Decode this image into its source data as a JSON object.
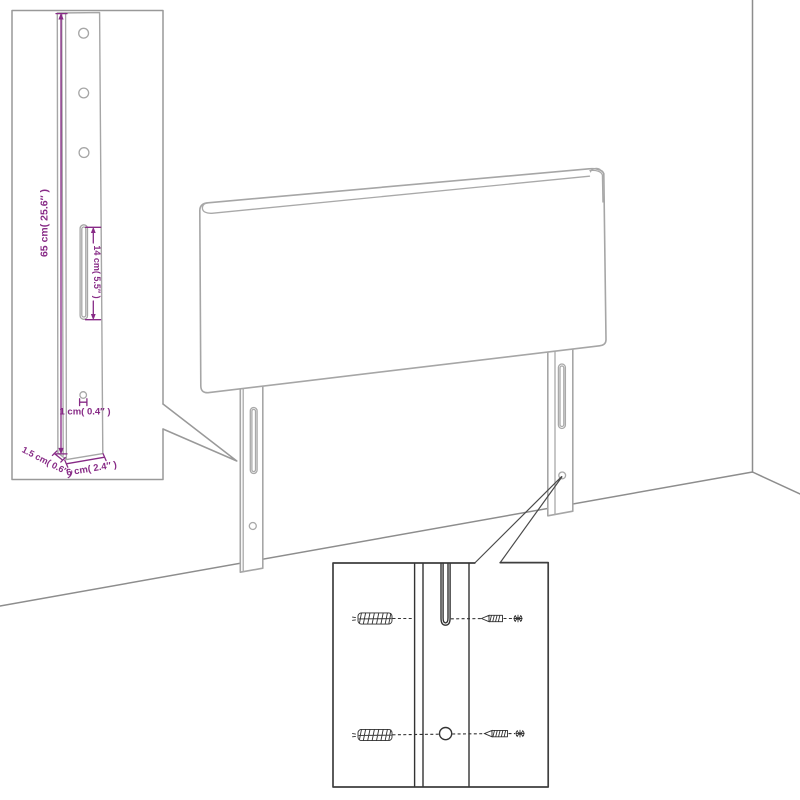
{
  "diagram": {
    "kind": "furniture-assembly-diagram",
    "subject": "headboard-wall-mounting"
  },
  "colors": {
    "background": "#ffffff",
    "product_outline": "#a6a6a6",
    "wall_floor_lines": "#8d8d8d",
    "left_inset_border": "#999999",
    "right_inset_border": "#3f3f3f",
    "hardware_lines": "#333333",
    "dimension_purple": "#872a86"
  },
  "dimension_labels": {
    "leg_height": "65 cm( 25.6″ )",
    "slot_length": "14 cm( 5.5″ )",
    "hole_diameter": "1 cm( 0.4″ )",
    "leg_thickness": "1.5 cm( 0.6″ )",
    "leg_width": "6 cm( 2.4″ )"
  },
  "hardware_inset": {
    "icons": [
      "wall-plug-icon",
      "screw-icon"
    ]
  }
}
